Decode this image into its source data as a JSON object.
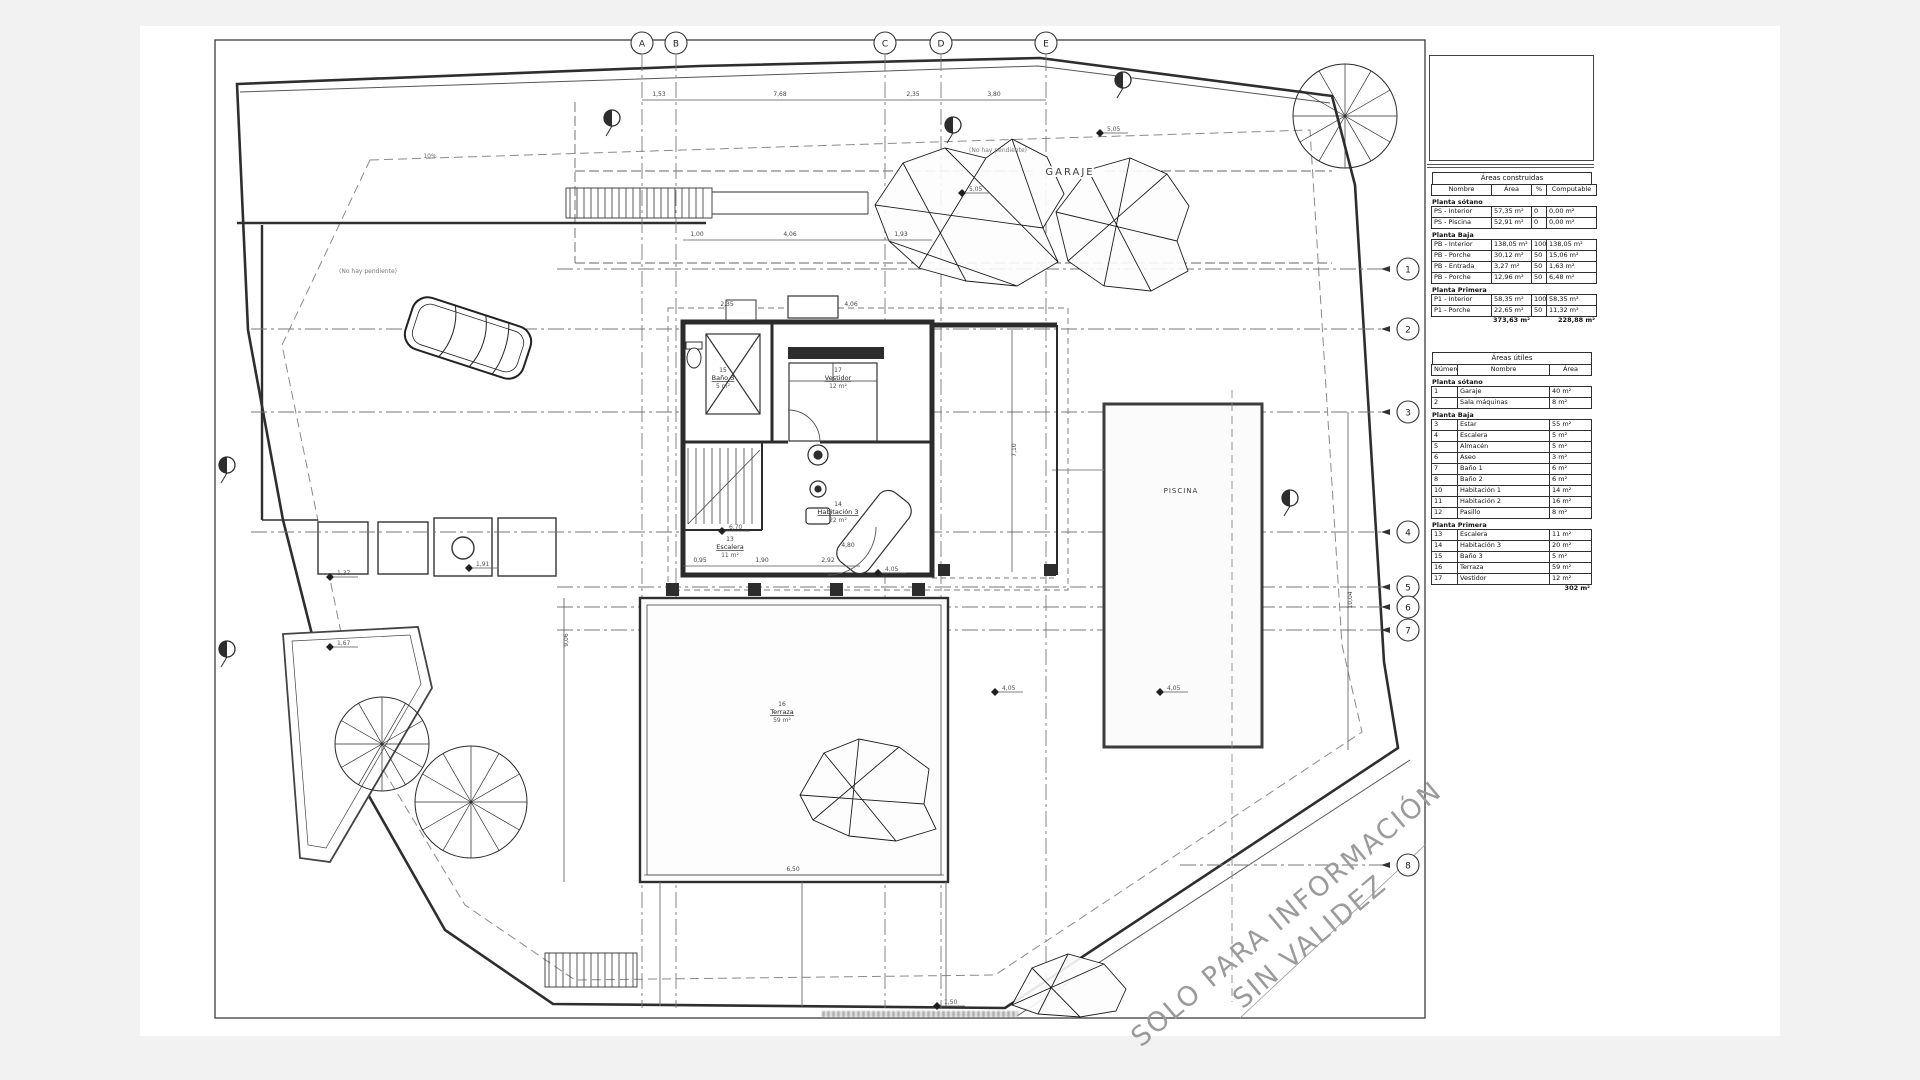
{
  "drawing": {
    "garaje_label": "GARAJE",
    "piscina_label": "PISCINA",
    "no_pendiente": "(No hay pendiente)",
    "slope_label": "10%",
    "watermark_line1": "SOLO PARA INFORMACIÓN",
    "watermark_line2": "SIN VALIDEZ",
    "grid_cols": [
      "A",
      "B",
      "C",
      "D",
      "E"
    ],
    "grid_rows": [
      "1",
      "2",
      "3",
      "4",
      "5",
      "6",
      "7",
      "8"
    ],
    "rooms": [
      {
        "num": "15",
        "name": "Baño 3",
        "area": "5 m²"
      },
      {
        "num": "17",
        "name": "Vestidor",
        "area": "12 m²"
      },
      {
        "num": "14",
        "name": "Habitación 3",
        "area": "22 m²"
      },
      {
        "num": "13",
        "name": "Escalera",
        "area": "11 m²"
      },
      {
        "num": "16",
        "name": "Terraza",
        "area": "59 m²"
      }
    ],
    "dims": [
      {
        "t": "1,53",
        "x": 659,
        "y": 96
      },
      {
        "t": "7,68",
        "x": 780,
        "y": 96
      },
      {
        "t": "2,35",
        "x": 913,
        "y": 96
      },
      {
        "t": "3,80",
        "x": 994,
        "y": 96
      },
      {
        "t": "1,00",
        "x": 697,
        "y": 236
      },
      {
        "t": "4,06",
        "x": 790,
        "y": 236
      },
      {
        "t": "1,93",
        "x": 901,
        "y": 236
      },
      {
        "t": "2,35",
        "x": 727,
        "y": 306
      },
      {
        "t": "4,06",
        "x": 851,
        "y": 306
      },
      {
        "t": "0,95",
        "x": 700,
        "y": 562
      },
      {
        "t": "1,90",
        "x": 762,
        "y": 562
      },
      {
        "t": "2,92",
        "x": 828,
        "y": 562
      },
      {
        "t": "4,80",
        "x": 848,
        "y": 547
      },
      {
        "t": "6,50",
        "x": 793,
        "y": 871
      },
      {
        "t": "7,10",
        "x": 1016,
        "y": 450,
        "rot": -90
      },
      {
        "t": "10,04",
        "x": 1352,
        "y": 600,
        "rot": -90
      },
      {
        "t": "9,06",
        "x": 568,
        "y": 640,
        "rot": -90
      }
    ],
    "levels": [
      {
        "t": "5,05",
        "x": 1100,
        "y": 133
      },
      {
        "t": "5,05",
        "x": 962,
        "y": 193
      },
      {
        "t": "6,70",
        "x": 722,
        "y": 531
      },
      {
        "t": "4,05",
        "x": 878,
        "y": 573
      },
      {
        "t": "4,05",
        "x": 995,
        "y": 692
      },
      {
        "t": "4,05",
        "x": 1160,
        "y": 692
      },
      {
        "t": "1,50",
        "x": 937,
        "y": 1006
      },
      {
        "t": "1,37",
        "x": 330,
        "y": 577
      },
      {
        "t": "1,67",
        "x": 330,
        "y": 647
      },
      {
        "t": "1,91",
        "x": 469,
        "y": 568
      }
    ]
  },
  "panel": {
    "construidas": {
      "title": "Áreas construidas",
      "columns": [
        "Nombre",
        "Área",
        "%",
        "Computable"
      ],
      "sections": [
        {
          "label": "Planta sótano",
          "rows": [
            [
              "PS - Interior",
              "57,35 m²",
              "0",
              "0,00 m²"
            ],
            [
              "PS - Piscina",
              "52,91 m²",
              "0",
              "0,00 m²"
            ]
          ]
        },
        {
          "label": "Planta Baja",
          "rows": [
            [
              "PB - Interior",
              "138,05 m²",
              "100",
              "138,05 m²"
            ],
            [
              "PB - Porche",
              "30,12 m²",
              "50",
              "15,06 m²"
            ],
            [
              "PB - Entrada",
              "3,27 m²",
              "50",
              "1,63 m²"
            ],
            [
              "PB - Porche",
              "12,96 m²",
              "50",
              "6,48 m²"
            ]
          ]
        },
        {
          "label": "Planta Primera",
          "rows": [
            [
              "P1 - Interior",
              "58,35 m²",
              "100",
              "58,35 m²"
            ],
            [
              "P1 - Porche",
              "22,65 m²",
              "50",
              "11,32 m²"
            ]
          ]
        }
      ],
      "totals": [
        "",
        "373,63 m²",
        "",
        "228,88 m²"
      ]
    },
    "utiles": {
      "title": "Áreas útiles",
      "columns": [
        "Número",
        "Nombre",
        "Área"
      ],
      "sections": [
        {
          "label": "Planta sótano",
          "rows": [
            [
              "1",
              "Garaje",
              "40 m²"
            ],
            [
              "2",
              "Sala máquinas",
              "8 m²"
            ]
          ]
        },
        {
          "label": "Planta Baja",
          "rows": [
            [
              "3",
              "Estar",
              "55 m²"
            ],
            [
              "4",
              "Escalera",
              "5 m²"
            ],
            [
              "5",
              "Almacén",
              "5 m²"
            ],
            [
              "6",
              "Aseo",
              "3 m²"
            ],
            [
              "7",
              "Baño 1",
              "6 m²"
            ],
            [
              "8",
              "Baño 2",
              "6 m²"
            ],
            [
              "10",
              "Habitación 1",
              "14 m²"
            ],
            [
              "11",
              "Habitación 2",
              "16 m²"
            ],
            [
              "12",
              "Pasillo",
              "8 m²"
            ]
          ]
        },
        {
          "label": "Planta Primera",
          "rows": [
            [
              "13",
              "Escalera",
              "11 m²"
            ],
            [
              "14",
              "Habitación 3",
              "20 m²"
            ],
            [
              "15",
              "Baño 3",
              "5 m²"
            ],
            [
              "16",
              "Terraza",
              "59 m²"
            ],
            [
              "17",
              "Vestidor",
              "12 m²"
            ]
          ]
        }
      ],
      "totals": [
        "",
        "",
        "302 m²"
      ]
    }
  }
}
